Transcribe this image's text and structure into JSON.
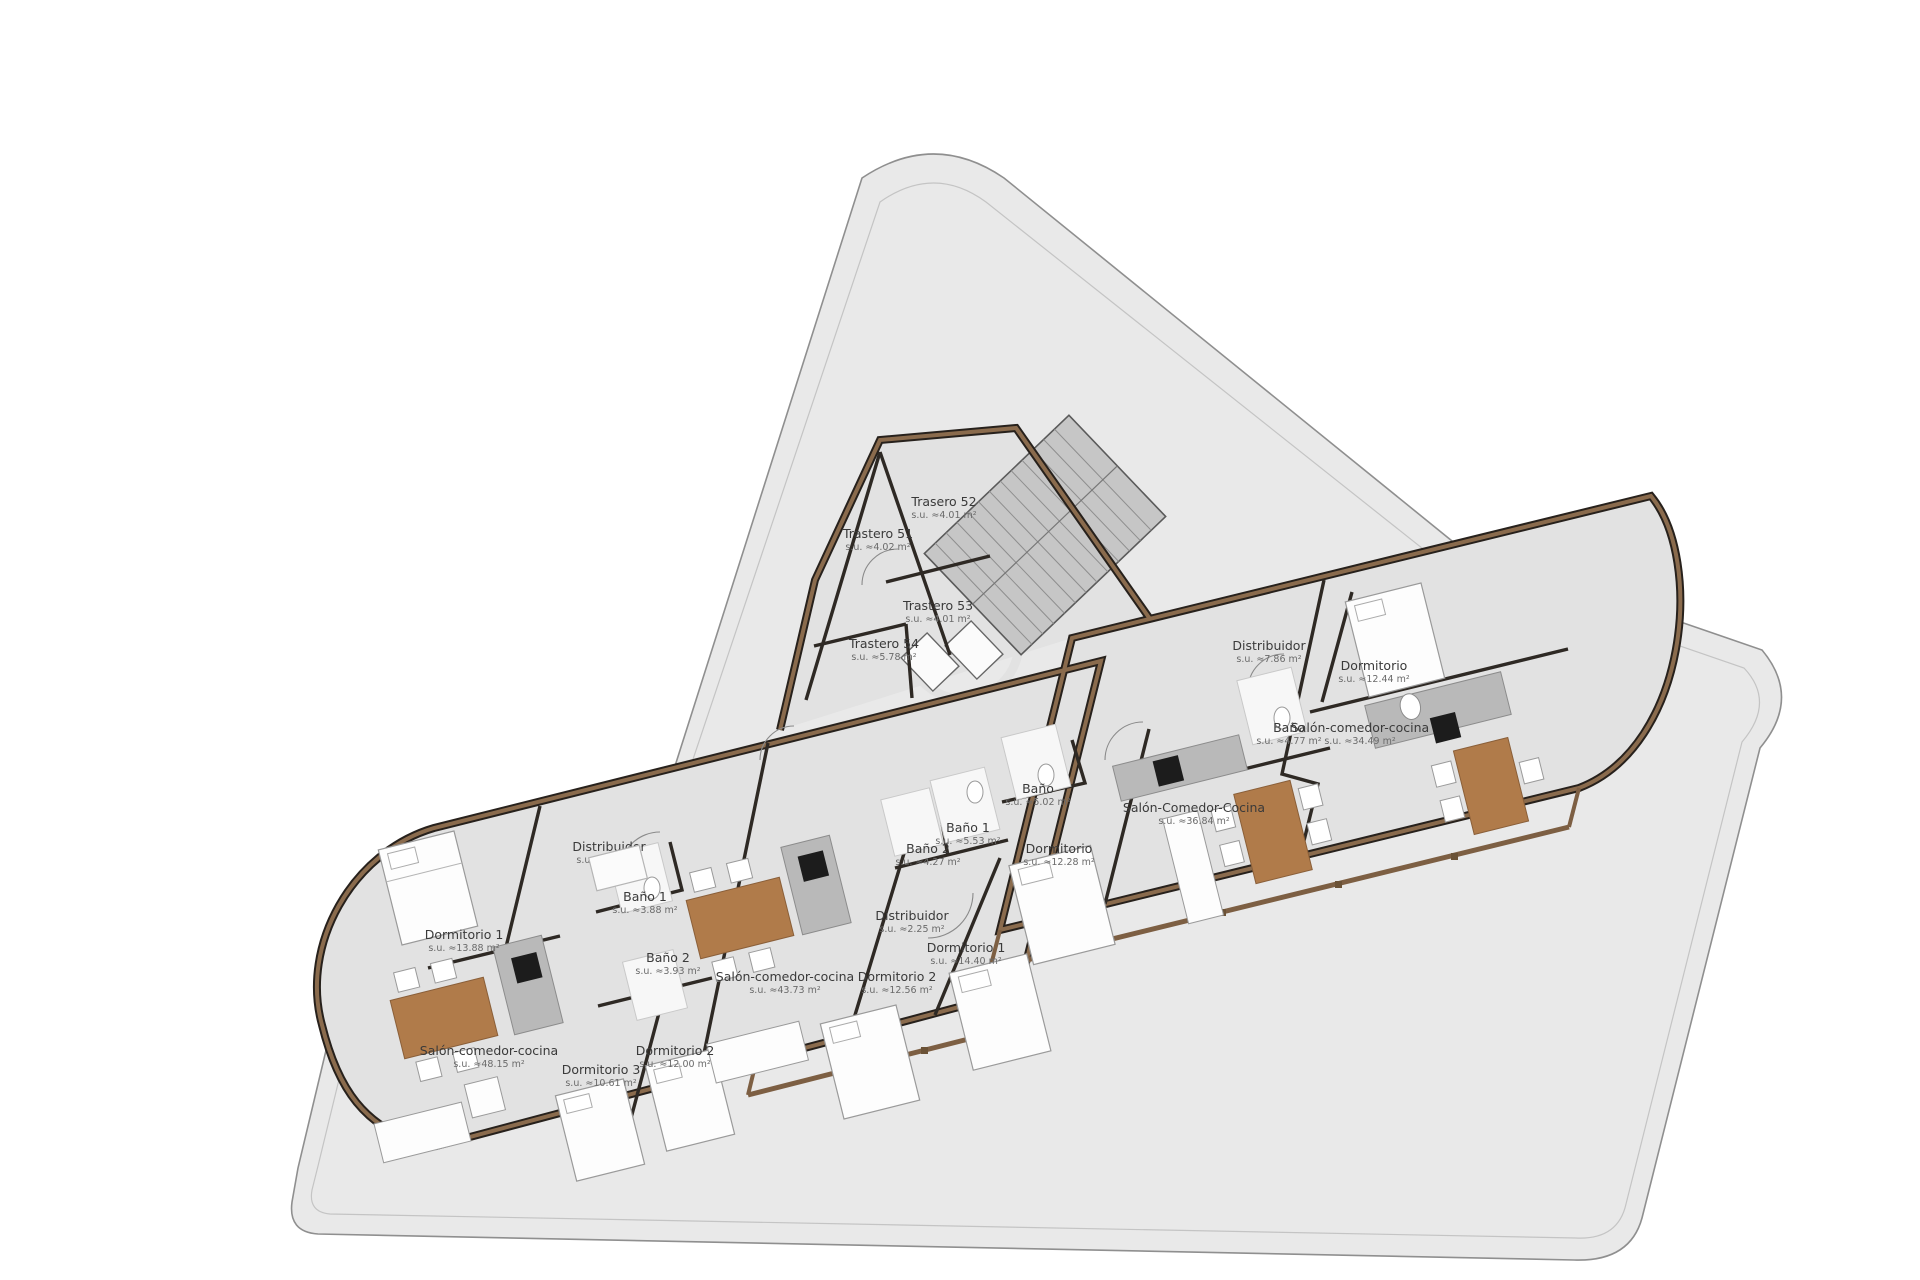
{
  "plan": {
    "colors": {
      "parcel": "#e9e9e9",
      "parcel_stroke": "#8f8f8f",
      "building_floor": "#e2e2e2",
      "wall_dark": "#27211c",
      "wall_brown": "#8a6b4d",
      "table_brown": "#b07b4a",
      "stair_fill": "#c6c6c6",
      "kitchen_gray": "#b9b9b9",
      "cooktop_black": "#1c1c1c"
    },
    "streets": [
      {
        "label": "CARRER MALAGA",
        "x": 397,
        "y": 587,
        "transform": "rotate(-62 397 587)"
      },
      {
        "label": "AVENIDA SANTA MARÍA",
        "x": 1549,
        "y": 283,
        "transform": "rotate(52 1549 283)"
      },
      {
        "label": "AVENIDA MADRID",
        "x": 1137,
        "y": 1208,
        "transform": "rotate(-10 1137 1208)"
      }
    ],
    "unit_letters": [
      {
        "label": "A",
        "x": 1126,
        "y": 757
      },
      {
        "label": "B",
        "x": 1191,
        "y": 691
      },
      {
        "label": "C",
        "x": 644,
        "y": 833
      },
      {
        "label": "D",
        "x": 754,
        "y": 870
      }
    ],
    "rooms": [
      {
        "label": "Trastero 51",
        "area": "s.u. ≈4.02 m²",
        "x": 878,
        "y": 538,
        "y2": 550
      },
      {
        "label": "Trasero 52",
        "area": "s.u. ≈4.01 m²",
        "x": 944,
        "y": 506,
        "y2": 518
      },
      {
        "label": "Trastero 53",
        "area": "s.u. ≈4.01 m²",
        "x": 938,
        "y": 610,
        "y2": 622
      },
      {
        "label": "Trastero 54",
        "area": "s.u. ≈5.78 m²",
        "x": 884,
        "y": 648,
        "y2": 660
      },
      {
        "label": "Distribuidor",
        "area": "s.u. ≈7.86 m²",
        "x": 1269,
        "y": 650,
        "y2": 662
      },
      {
        "label": "Dormitorio",
        "area": "s.u. ≈12.44 m²",
        "x": 1374,
        "y": 670,
        "y2": 682
      },
      {
        "label": "Baño",
        "area": "s.u. ≈4.77 m²",
        "x": 1289,
        "y": 732,
        "y2": 744
      },
      {
        "label": "Salón-comedor-cocina",
        "area": "s.u. ≈34.49 m²",
        "x": 1360,
        "y": 732,
        "y2": 744
      },
      {
        "label": "Baño",
        "area": "s.u. ≈5.02 m²",
        "x": 1038,
        "y": 793,
        "y2": 805
      },
      {
        "label": "Salón-Comedor-Cocina",
        "area": "s.u. ≈36.84 m²",
        "x": 1194,
        "y": 812,
        "y2": 824
      },
      {
        "label": "Dormitorio",
        "area": "s.u. ≈12.28 m²",
        "x": 1059,
        "y": 853,
        "y2": 865
      },
      {
        "label": "Baño 1",
        "area": "s.u. ≈5.53 m²",
        "x": 968,
        "y": 832,
        "y2": 844
      },
      {
        "label": "Baño 2",
        "area": "s.u. ≈4.27 m²",
        "x": 928,
        "y": 853,
        "y2": 865
      },
      {
        "label": "Distribuidor",
        "area": "s.u. ≈2.25 m²",
        "x": 912,
        "y": 920,
        "y2": 932
      },
      {
        "label": "Dormitorio 1",
        "area": "s.u. ≈14.40 m²",
        "x": 966,
        "y": 952,
        "y2": 964
      },
      {
        "label": "Dormitorio 2",
        "area": "s.u. ≈12.56 m²",
        "x": 897,
        "y": 981,
        "y2": 993
      },
      {
        "label": "Salón-comedor-cocina",
        "area": "s.u. ≈43.73 m²",
        "x": 785,
        "y": 981,
        "y2": 993
      },
      {
        "label": "Distribuidor",
        "area": "s.u. ≈5.66 m²",
        "x": 609,
        "y": 851,
        "y2": 863
      },
      {
        "label": "Baño 1",
        "area": "s.u. ≈3.88 m²",
        "x": 645,
        "y": 901,
        "y2": 913
      },
      {
        "label": "Baño 2",
        "area": "s.u. ≈3.93 m²",
        "x": 668,
        "y": 962,
        "y2": 974
      },
      {
        "label": "Dormitorio 1",
        "area": "s.u. ≈13.88 m²",
        "x": 464,
        "y": 939,
        "y2": 951
      },
      {
        "label": "Salón-comedor-cocina",
        "area": "s.u. ≈48.15 m²",
        "x": 489,
        "y": 1055,
        "y2": 1067
      },
      {
        "label": "Dormitorio 3",
        "area": "s.u. ≈10.61 m²",
        "x": 601,
        "y": 1074,
        "y2": 1086
      },
      {
        "label": "Dormitorio 2",
        "area": "s.u. ≈12.00 m²",
        "x": 675,
        "y": 1055,
        "y2": 1067
      }
    ]
  }
}
